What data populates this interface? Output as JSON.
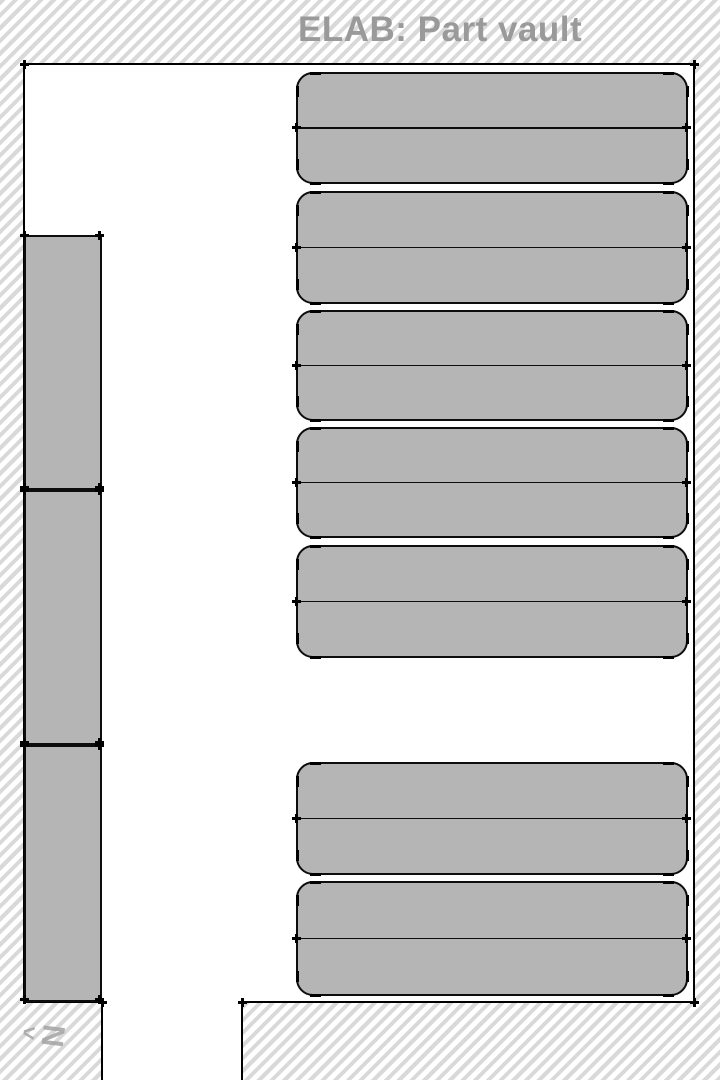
{
  "title": "ELAB: Part vault",
  "compass": {
    "arrow": "^",
    "label": "N"
  },
  "colors": {
    "hatch_stripe": "#d9d9d9",
    "room_floor": "#ffffff",
    "wall": "#000000",
    "shelf_fill": "#b5b5b5",
    "shelf_outline": "#0d0d0d",
    "title_text": "#9a9a9a",
    "compass_text": "#a3a3a3"
  },
  "floorplan": {
    "canvas": {
      "width": 720,
      "height": 1080
    },
    "room_areas": [
      {
        "name": "vault-floor",
        "x": 24,
        "y": 64,
        "w": 670,
        "h": 938
      },
      {
        "name": "doorway-corridor",
        "x": 102,
        "y": 1002,
        "w": 140,
        "h": 78
      }
    ],
    "walls": [
      {
        "name": "wall-top",
        "x": 23,
        "y": 63,
        "w": 672,
        "h": 2
      },
      {
        "name": "wall-left",
        "x": 23,
        "y": 63,
        "w": 2,
        "h": 940
      },
      {
        "name": "wall-right",
        "x": 693,
        "y": 63,
        "w": 2,
        "h": 940
      },
      {
        "name": "wall-bottom-left-segment",
        "x": 23,
        "y": 1001,
        "w": 80,
        "h": 2
      },
      {
        "name": "wall-bottom-right-segment",
        "x": 241,
        "y": 1001,
        "w": 454,
        "h": 2
      },
      {
        "name": "wall-corridor-left",
        "x": 101,
        "y": 1001,
        "w": 2,
        "h": 79
      },
      {
        "name": "wall-corridor-right",
        "x": 241,
        "y": 1001,
        "w": 2,
        "h": 79
      }
    ],
    "corner_marks": [
      {
        "x": 24,
        "y": 64
      },
      {
        "x": 694,
        "y": 64
      },
      {
        "x": 694,
        "y": 1002
      },
      {
        "x": 242,
        "y": 1002
      },
      {
        "x": 102,
        "y": 1002
      }
    ],
    "left_shelves": [
      {
        "x": 24,
        "y": 235,
        "w": 78,
        "h": 255
      },
      {
        "x": 24,
        "y": 490,
        "w": 78,
        "h": 255
      },
      {
        "x": 24,
        "y": 745,
        "w": 78,
        "h": 257
      }
    ],
    "right_shelves": [
      {
        "x": 296,
        "y": 72,
        "w": 392,
        "h": 112,
        "rows": 2
      },
      {
        "x": 296,
        "y": 191,
        "w": 392,
        "h": 113,
        "rows": 2
      },
      {
        "x": 296,
        "y": 310,
        "w": 392,
        "h": 111,
        "rows": 2
      },
      {
        "x": 296,
        "y": 427,
        "w": 392,
        "h": 111,
        "rows": 2
      },
      {
        "x": 296,
        "y": 545,
        "w": 392,
        "h": 113,
        "rows": 2
      },
      {
        "x": 296,
        "y": 762,
        "w": 392,
        "h": 113,
        "rows": 2
      },
      {
        "x": 296,
        "y": 881,
        "w": 392,
        "h": 115,
        "rows": 2
      }
    ]
  }
}
